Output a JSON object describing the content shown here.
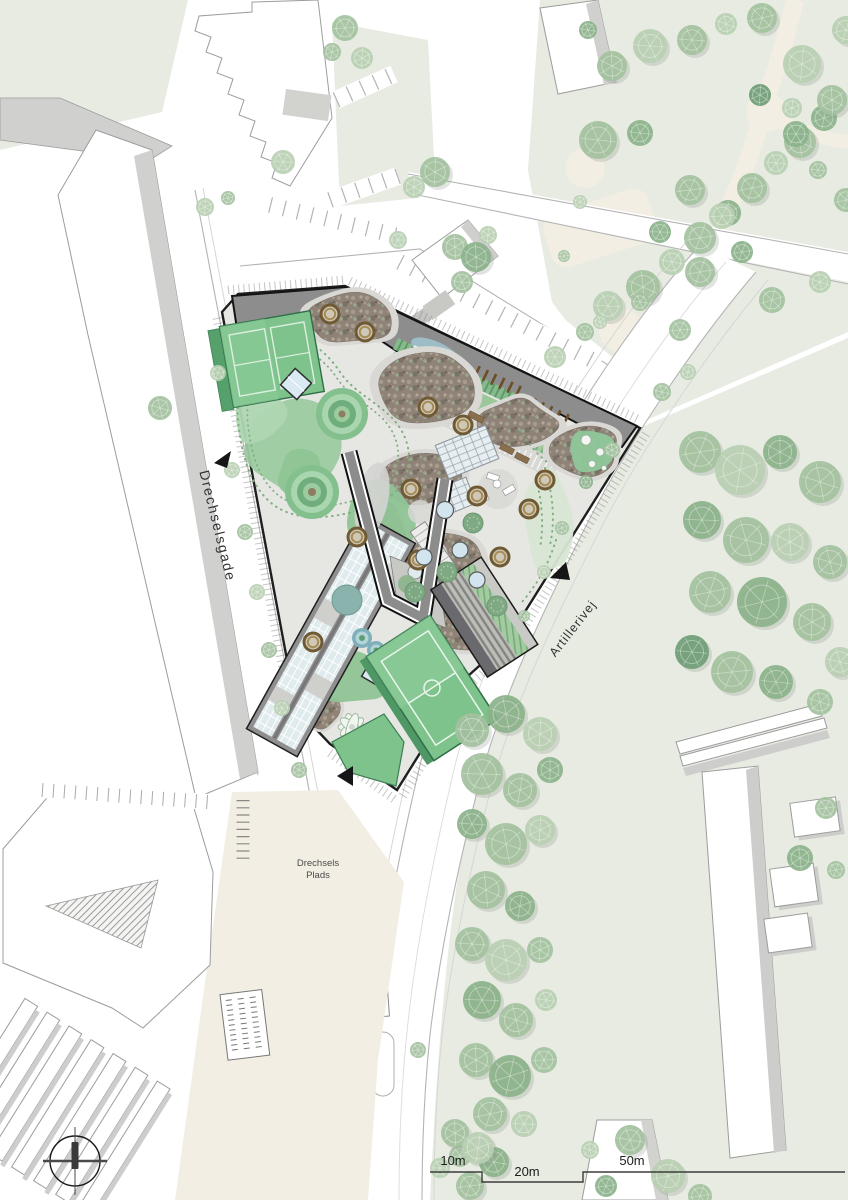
{
  "streets": {
    "west": "Drechselsgade",
    "east": "Artillerivej"
  },
  "plaza": {
    "name_line1": "Drechsels",
    "name_line2": "Plads"
  },
  "scale_bar": {
    "ticks": [
      "10m",
      "20m",
      "50m"
    ]
  },
  "icons": {
    "compass": "compass-north-icon",
    "entrance_arrow": "entrance-arrow-icon"
  },
  "colors": {
    "roof_gray": "#8d8d8d",
    "outline_black": "#1a1a1a",
    "court_green": "#7ec28c",
    "mound_green": "#9ccb9f",
    "lawn_green": "#e7ebe2",
    "plaza_beige": "#f2eee3",
    "planting_brown": "#8f8378",
    "glass_blue": "#dfeaed",
    "tree_green": "#9cbd98",
    "path_cream": "#f2eee3"
  }
}
